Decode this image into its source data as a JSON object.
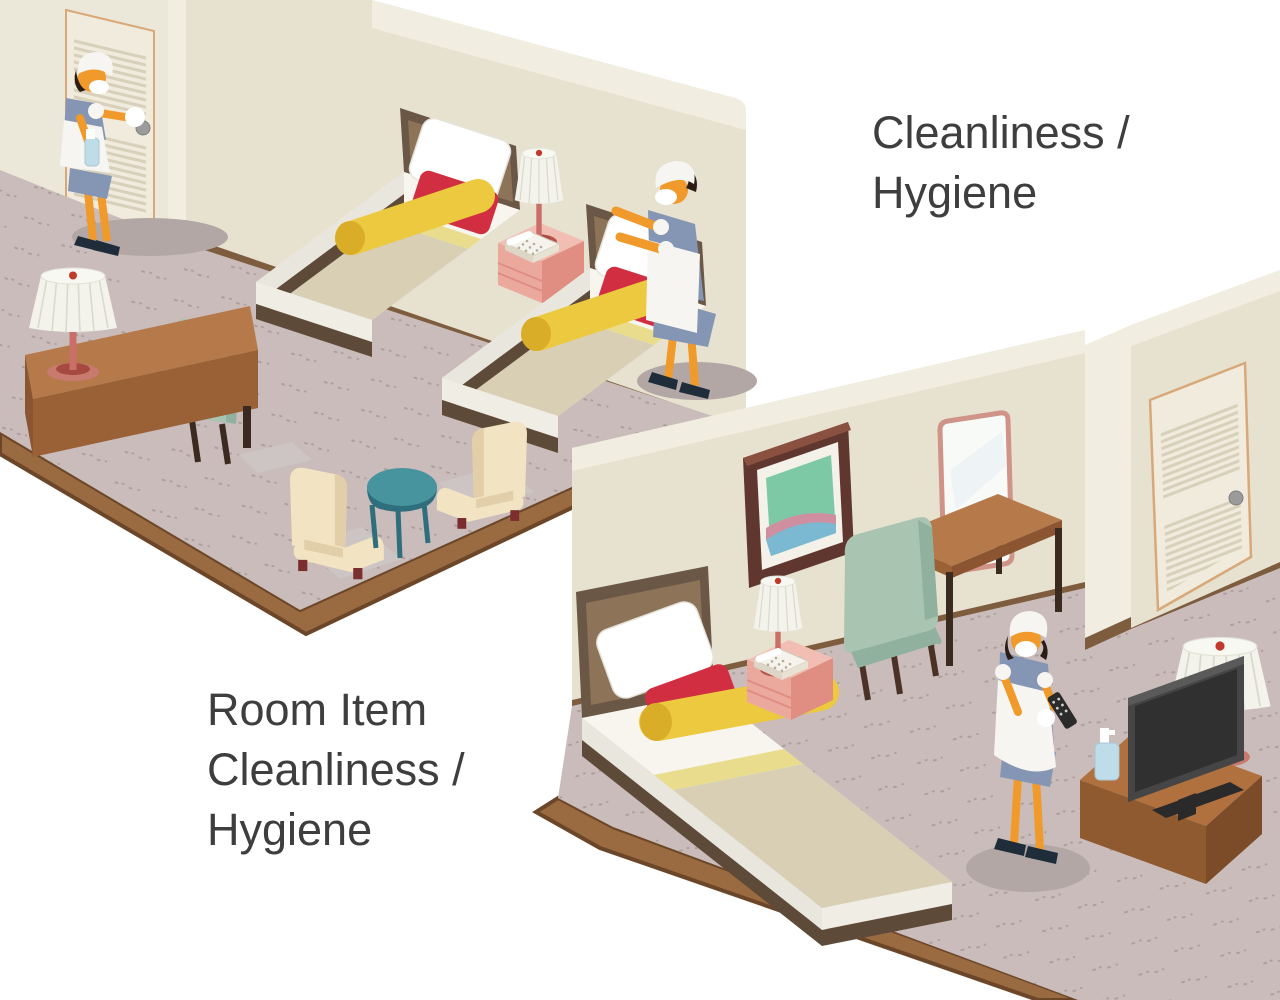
{
  "labels": {
    "cleanliness": "Cleanliness /\nHygiene",
    "room_item": "Room Item\nCleanliness /\nHygiene"
  },
  "scene": {
    "description": "Isometric illustration of hotel housekeeping staff cleaning and sanitizing two guest rooms",
    "rooms": [
      {
        "name": "twin-room",
        "items": [
          "louvered-closet-door",
          "housekeeper-spraying-door-handle",
          "spray-bottle",
          "twin-bed-1",
          "twin-bed-2",
          "nightstand",
          "table-lamp",
          "telephone",
          "housekeeper-making-bed",
          "pillow",
          "desk",
          "desk-lamp",
          "desk-chair",
          "armchair-left",
          "armchair-right",
          "round-side-table",
          "carpet"
        ]
      },
      {
        "name": "single-room",
        "items": [
          "wall-art",
          "mirror",
          "writing-desk",
          "upholstered-chair",
          "single-bed",
          "nightstand",
          "table-lamp",
          "telephone",
          "housekeeper-sanitizing-tv-remote",
          "tv-remote",
          "cleaning-cloth",
          "flat-screen-tv",
          "tv-cabinet",
          "hand-sanitizer-bottle",
          "floor-lamp",
          "louvered-door",
          "carpet"
        ]
      }
    ]
  },
  "palette": {
    "background": "#ffffff",
    "text": "#3e3e3e",
    "wall": "#e7e2d0",
    "carpet": "#c9bcba",
    "wood_trim": "#9a6a40",
    "bed_blanket": "#d8cfb5",
    "accent_pillow_red": "#d22e42",
    "bolster_yellow": "#ecc93f",
    "nightstand_pink": "#eba99e",
    "maid_dress_blue": "#8496b4",
    "chair_sage": "#a9c4b1",
    "table_teal": "#47939e"
  }
}
